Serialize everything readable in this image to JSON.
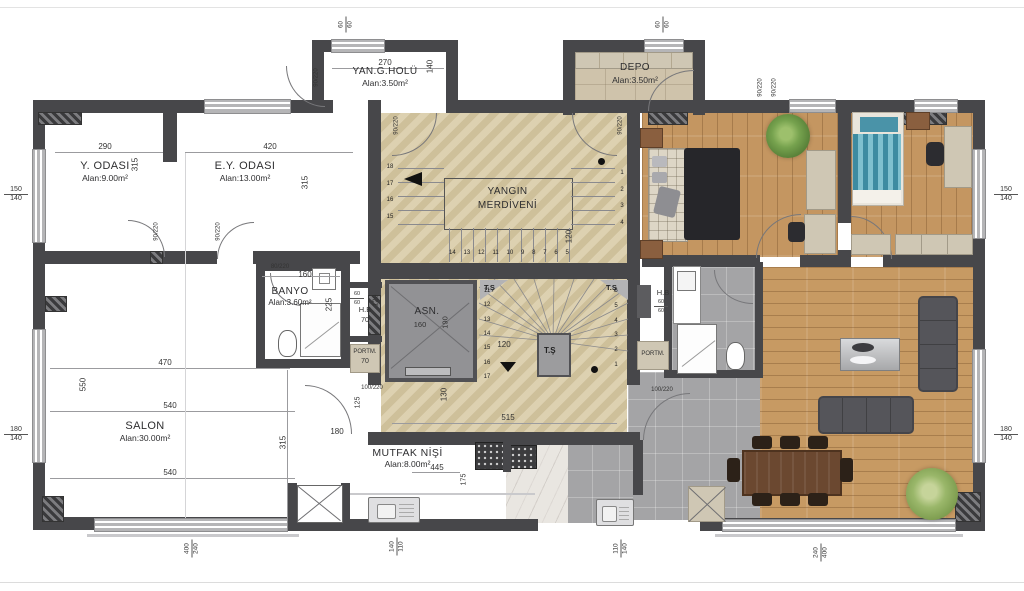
{
  "colors": {
    "wall": "#47474a",
    "window": "#c6c6c8",
    "stone_floor": "#d8caa5",
    "wood_floor": "#c49661",
    "tile_floor": "#a4a4a6",
    "bed_accent": "#4a93a8"
  },
  "rooms": {
    "y_odasi": {
      "name": "Y. ODASI",
      "area": "Alan:9.00m²",
      "width": "290",
      "height": "315"
    },
    "ey_odasi": {
      "name": "E.Y. ODASI",
      "area": "Alan:13.00m²",
      "width": "420",
      "height": "315"
    },
    "yan_g_holu": {
      "name": "YAN.G.HOLÜ",
      "area": "Alan:3.50m²",
      "width": "270",
      "height": "140"
    },
    "depo": {
      "name": "DEPO",
      "area": "Alan:3.50m²"
    },
    "banyo": {
      "name": "BANYO",
      "area": "Alan:3.60m²",
      "width": "160",
      "height": "225"
    },
    "salon": {
      "name": "SALON",
      "area": "Alan:30.00m²",
      "dim_top": "470",
      "dim_mid": "540",
      "dim_bottom": "540",
      "dim_left": "550",
      "dim_right": "315",
      "dim_gap": "180"
    },
    "mutfak": {
      "name": "MUTFAK NİŞİ",
      "area": "Alan:8.00m²",
      "width": "445",
      "height": "175"
    },
    "hb_left": {
      "label": "H.B",
      "size_top": "60",
      "size_bottom": "60",
      "width": "70",
      "depth": "120"
    },
    "portm_left": {
      "label": "PORTM.",
      "width": "70"
    },
    "hb_right": {
      "label": "H.B",
      "size_top": "60",
      "size_bottom": "60"
    },
    "portm_right": {
      "label": "PORTM."
    },
    "asansor": {
      "name": "ASN.",
      "width": "160",
      "depth": "190"
    }
  },
  "stairs": {
    "fire": {
      "title_line1": "YANGIN",
      "title_line2": "MERDİVENİ",
      "left_steps": [
        "18",
        "17",
        "16",
        "15"
      ],
      "right_steps": [
        "1",
        "2",
        "3",
        "4"
      ],
      "bottom_steps": [
        "14",
        "13",
        "12",
        "11",
        "10",
        "9",
        "8",
        "7",
        "6",
        "5"
      ],
      "width": "120"
    },
    "main": {
      "corner_label": "T.Ş",
      "center_label": "T.Ş",
      "left_steps": [
        "11",
        "12",
        "13",
        "14",
        "15",
        "16",
        "17"
      ],
      "right_steps": [
        "6",
        "5",
        "4",
        "3",
        "2",
        "1"
      ],
      "width": "120"
    },
    "landing": {
      "depth": "130",
      "width": "515",
      "entry_left": "125"
    }
  },
  "doors": {
    "standard": "90/220",
    "bath": "80/220",
    "entry": "100/220"
  },
  "edge": {
    "left_top": [
      "150",
      "140"
    ],
    "left_bottom": [
      "180",
      "140"
    ],
    "right_top": [
      "150",
      "140"
    ],
    "right_bottom": [
      "180",
      "140"
    ],
    "top_left_win": [
      "60",
      "60"
    ],
    "top_right_win": [
      "60",
      "60"
    ],
    "bottom_1": [
      "400",
      "240"
    ],
    "bottom_2": [
      "140",
      "110"
    ],
    "bottom_3": [
      "110",
      "140"
    ],
    "bottom_4": [
      "240",
      "400"
    ]
  }
}
